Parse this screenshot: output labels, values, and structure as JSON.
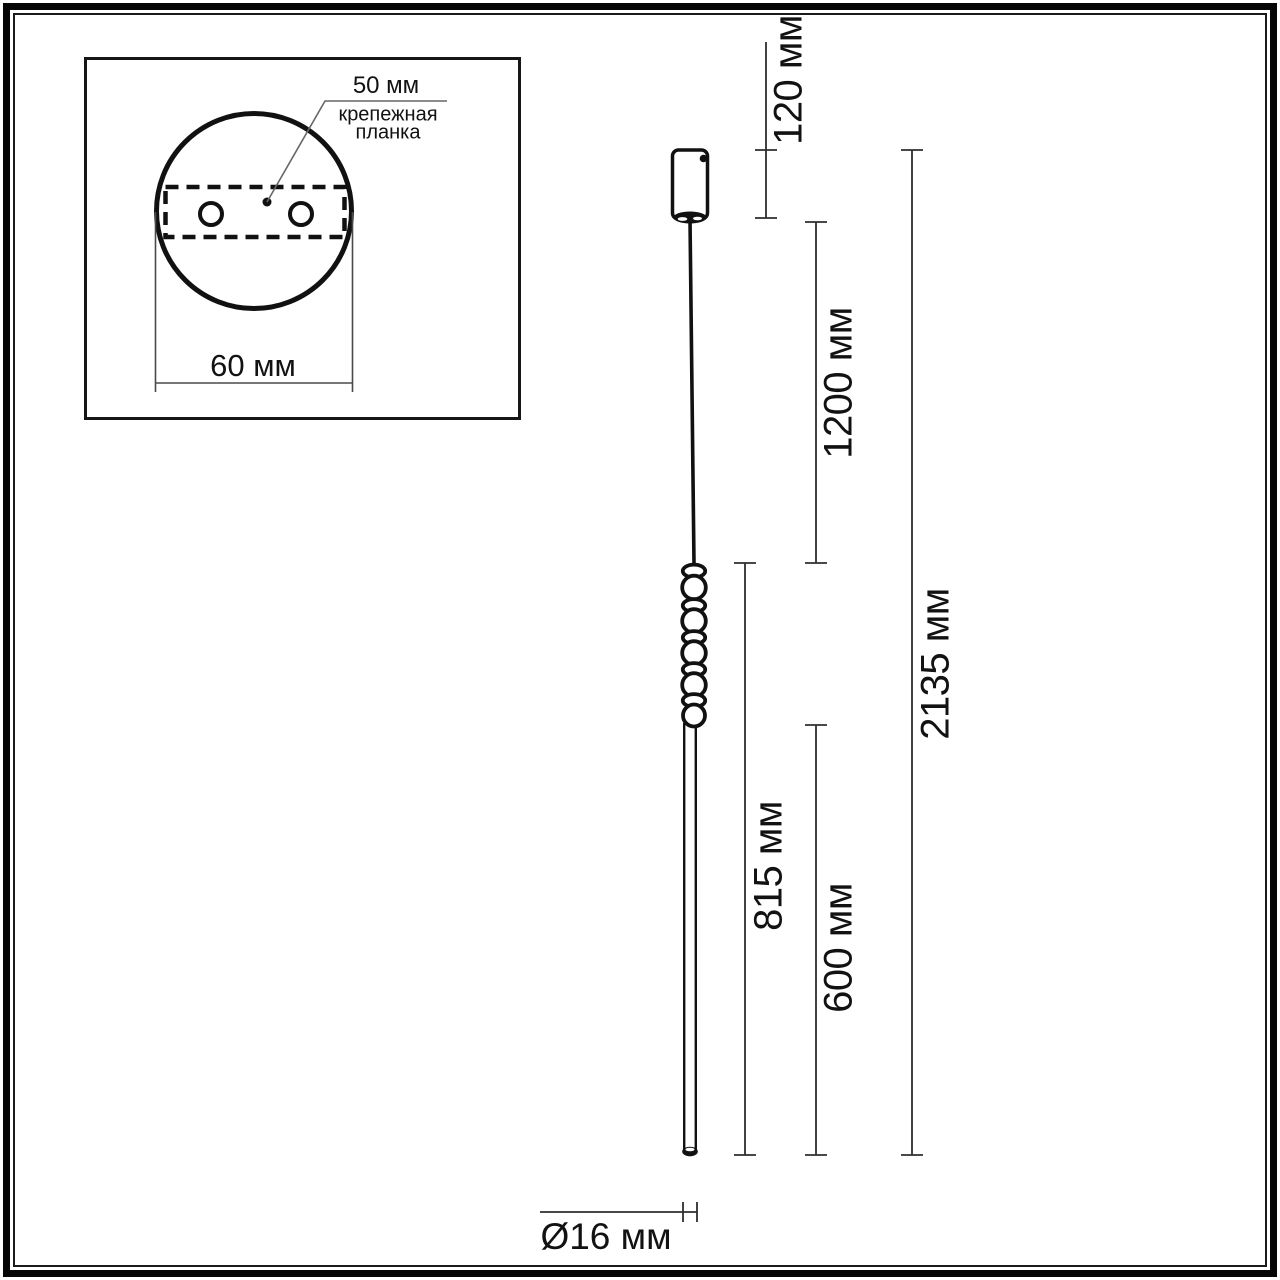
{
  "inset": {
    "hole_spacing_label": "50 мм",
    "plate_label": "крепежная планка",
    "plate_width_label": "60 мм"
  },
  "dimensions": {
    "canopy_height_label": "120 мм",
    "suspension_length_label": "1200 мм",
    "overall_height_label": "2135 мм",
    "fixture_length_label": "815 мм",
    "tube_length_label": "600 мм",
    "diameter_label": "Ø16 мм"
  },
  "colors": {
    "drawing_line": "#111111",
    "dimension_line": "#2e2e2e",
    "inset_dimension_line": "#4a4a4a",
    "leader_line": "#666666",
    "background": "#ffffff"
  }
}
